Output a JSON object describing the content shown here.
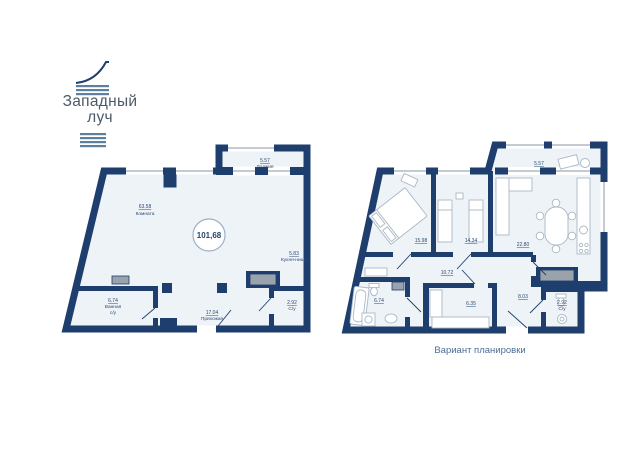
{
  "logo": {
    "title_line1": "Западный",
    "title_line2": "луч"
  },
  "caption": "Вариант планировки",
  "left_plan": {
    "total_area": "101,68",
    "rooms": {
      "room": {
        "area": "63.58",
        "name": "Комната"
      },
      "loggia": {
        "area": "5.57",
        "name": "Лоджия"
      },
      "kitchen_niche": {
        "area": "5.83",
        "name": "Кухня-ниша"
      },
      "bathroom": {
        "area": "6.74",
        "name": "Ванная",
        "name2": "с/у"
      },
      "hallway": {
        "area": "17.04",
        "name": "Прихожая"
      },
      "wc": {
        "area": "2.92",
        "name": "С/у"
      }
    }
  },
  "right_plan": {
    "rooms": {
      "bedroom1": {
        "area": "15.98"
      },
      "bedroom2": {
        "area": "14.34"
      },
      "living": {
        "area": "22.80"
      },
      "loggia": {
        "area": "5.57"
      },
      "corridor": {
        "area": "10.72"
      },
      "bathroom": {
        "area": "6.74"
      },
      "storage": {
        "area": "6.35"
      },
      "hall": {
        "area": "8.03"
      },
      "wc": {
        "area": "2.92",
        "name": "С/у"
      }
    }
  },
  "colors": {
    "wall": "#1e3e6d",
    "floor": "#eef3f8",
    "label": "#2b4a72",
    "shaft_gray": "#9aa2ab",
    "window_gray": "#c3cad1",
    "furniture_gray": "#abb7c5",
    "logo_slate": "#5e80a0",
    "logo_text": "#4c5a68",
    "caption_blue": "#4a6e96"
  }
}
